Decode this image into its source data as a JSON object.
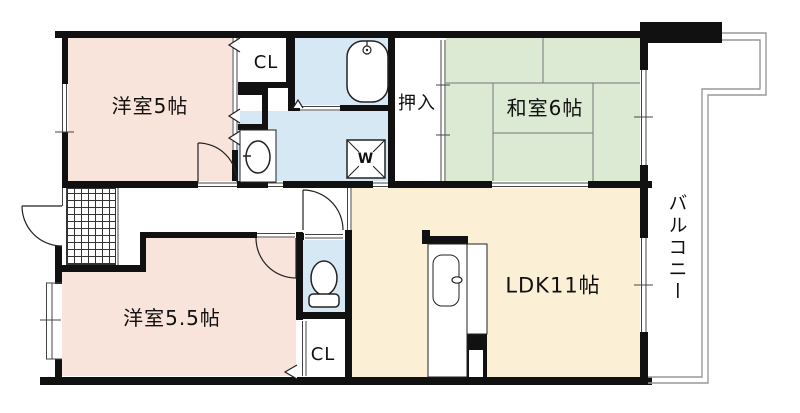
{
  "plan_title": "apartment-floor-plan",
  "rooms": {
    "western_room_top": {
      "label": "洋室5帖"
    },
    "japanese_room": {
      "label": "和室6帖"
    },
    "western_room_bottom": {
      "label": "洋室5.5帖"
    },
    "ldk": {
      "label": "LDK11帖"
    },
    "balcony": {
      "label": "バルコニー"
    },
    "oshiire_closet": {
      "label": "押入"
    },
    "closet_top": {
      "label": "CL"
    },
    "closet_bottom": {
      "label": "CL"
    }
  },
  "fixtures": {
    "washing_machine_label": "W"
  },
  "colors": {
    "wall": "#111111",
    "pink": "#f8e4da",
    "green": "#dcead4",
    "cream": "#fbf0d6",
    "blue": "#d6e8f4",
    "thin": "#444444",
    "balc": "#999999",
    "paper": "#ffffff"
  }
}
